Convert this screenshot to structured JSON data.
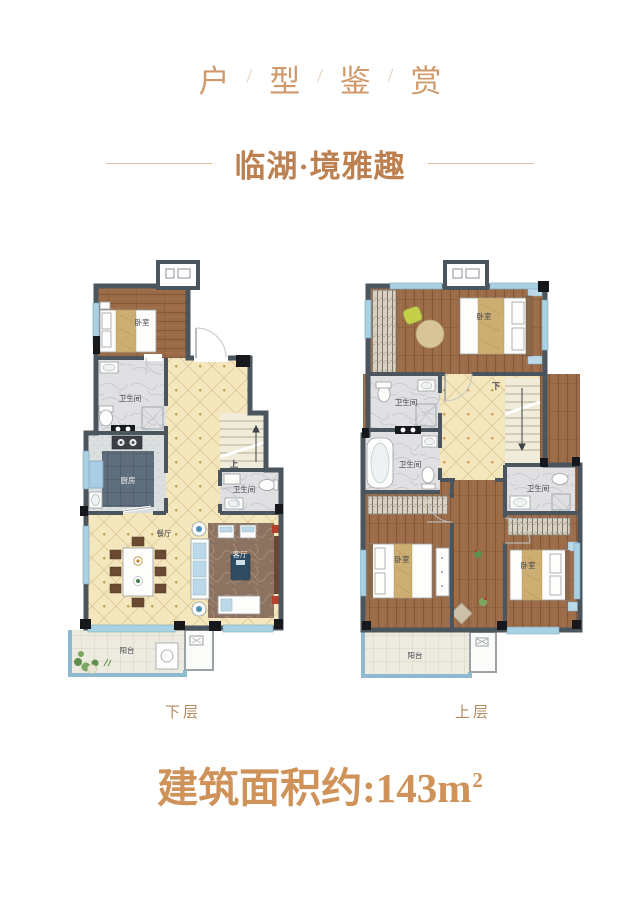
{
  "header": {
    "title_chars": [
      "户",
      "型",
      "鉴",
      "赏"
    ],
    "separator": "/",
    "subtitle": "临湖·境雅趣"
  },
  "plans": {
    "lower": {
      "caption": "下层",
      "rooms": {
        "bedroom": "卧室",
        "bathroom_1": "卫生间",
        "bathroom_2": "卫生间",
        "kitchen": "厨房",
        "dining": "餐厅",
        "living": "客厅",
        "balcony": "阳台",
        "stairs_up": "上"
      }
    },
    "upper": {
      "caption": "上层",
      "rooms": {
        "bedroom_master": "卧室",
        "bedroom_2": "卧室",
        "bedroom_3": "卧室",
        "bathroom_1": "卫生间",
        "bathroom_2": "卫生间",
        "bathroom_3": "卫生间",
        "balcony": "阳台",
        "stairs_down": "下"
      }
    }
  },
  "footer": {
    "area_text": "建筑面积约:143m",
    "area_sup": "2"
  },
  "colors": {
    "accent_title": "#d09a6d",
    "accent_subtitle": "#bd8050",
    "accent_area": "#cf9258",
    "wall": "#4b555e",
    "wood_floor": "#9b6a47",
    "tile_beige": "#f4e7bd",
    "window_blue": "#a8d2e3",
    "balcony_wall": "#8fb9ce"
  }
}
